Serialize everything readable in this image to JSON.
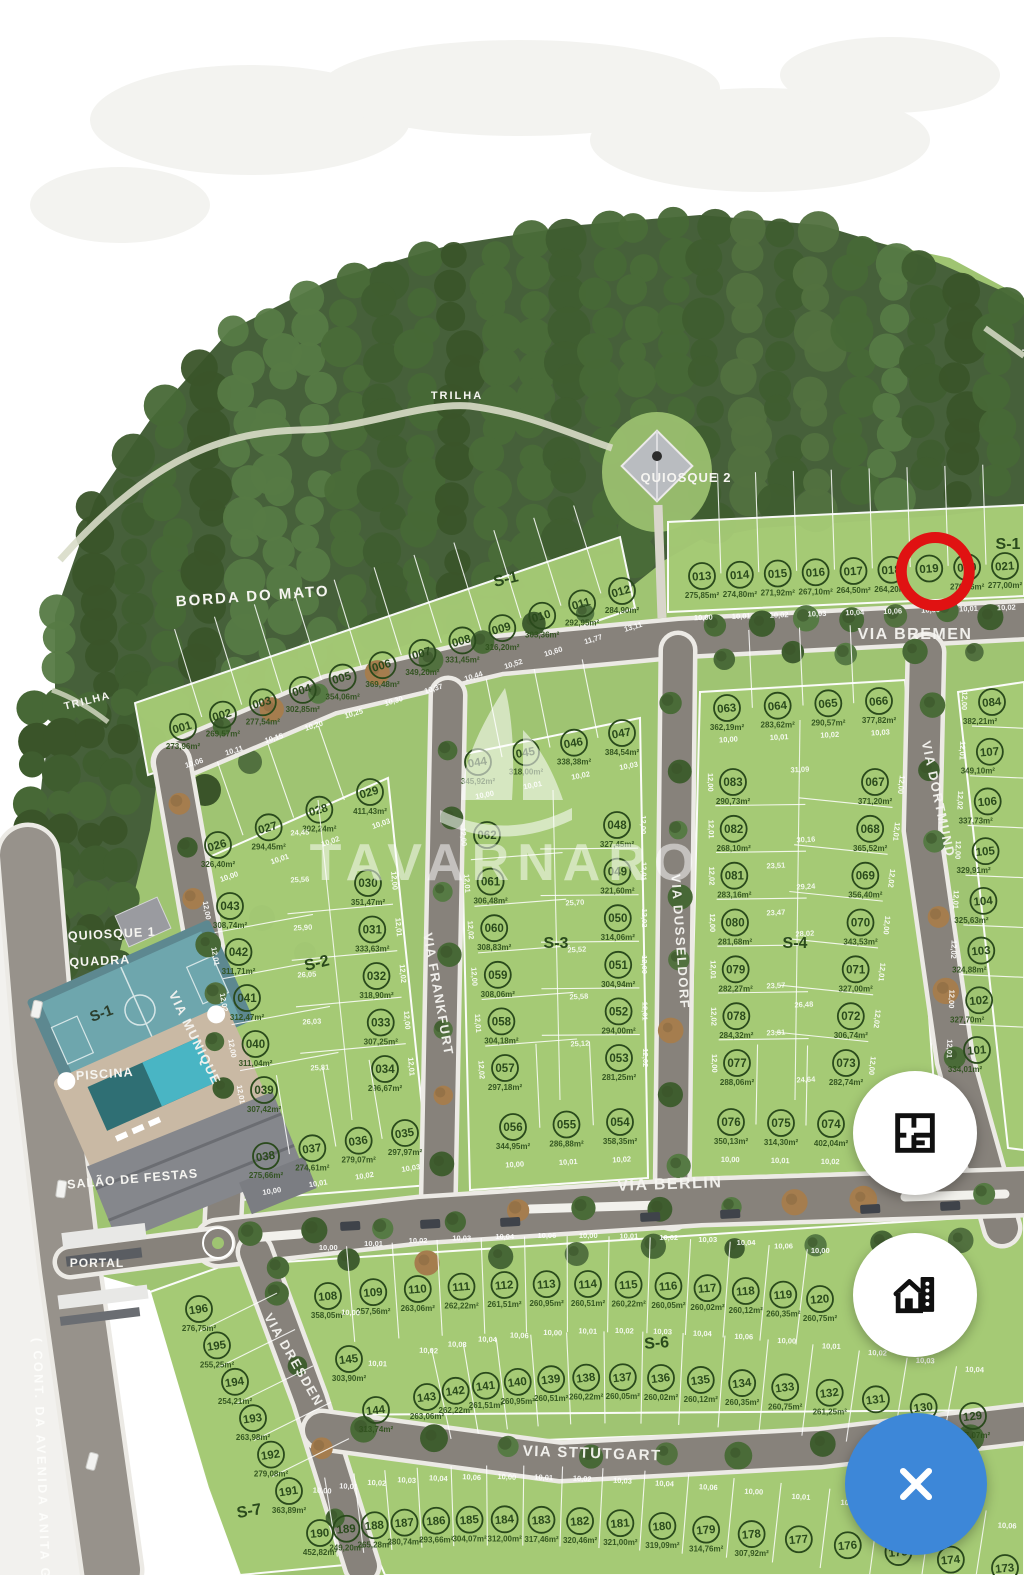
{
  "viewer": {
    "watermark": "TAVARNARO",
    "buttons": [
      {
        "id": "floorplan",
        "icon": "floor-plan-icon"
      },
      {
        "id": "units",
        "icon": "house-building-icon"
      },
      {
        "id": "close",
        "icon": "close-x-icon"
      }
    ]
  },
  "highlight": {
    "lot": "019",
    "color": "#e01212"
  },
  "labels": {
    "borda_do_mato": "BORDA DO MATO",
    "trilha_top": "TRILHA",
    "trilha_left": "TRILHA",
    "trilha_right": "TRILHA",
    "quiosque_1": "QUIOSQUE 1",
    "quiosque_2": "QUIOSQUE 2",
    "quadra": "QUADRA",
    "quadra_section": "S-1",
    "piscina": "PISCINA",
    "salao_de_festas": "SALÃO DE FESTAS",
    "portal": "PORTAL",
    "avenue": "( CONT. DA AVENIDA ANITA GARI"
  },
  "streets": [
    {
      "name": "VIA BREMEN"
    },
    {
      "name": "VIA MUNIQUE"
    },
    {
      "name": "VIA FRANKFURT"
    },
    {
      "name": "VIA DUSSELDORF"
    },
    {
      "name": "VIA DORTMUND"
    },
    {
      "name": "VIA BERLIN"
    },
    {
      "name": "VIA DRESDEN"
    },
    {
      "name": "VIA STTUTGART"
    }
  ],
  "sections": [
    {
      "id": "S-1",
      "strips": {
        "row_a": [
          {
            "n": "001",
            "a": "273,96m²"
          },
          {
            "n": "002",
            "a": "269,57m²"
          },
          {
            "n": "003",
            "a": "277,54m²"
          },
          {
            "n": "004",
            "a": "302,85m²"
          },
          {
            "n": "005",
            "a": "354,06m²"
          },
          {
            "n": "006",
            "a": "369,48m²"
          },
          {
            "n": "007",
            "a": "349,20m²"
          },
          {
            "n": "008",
            "a": "331,45m²"
          },
          {
            "n": "009",
            "a": "316,20m²"
          },
          {
            "n": "010",
            "a": "303,36m²"
          },
          {
            "n": "011",
            "a": "292,95m²"
          },
          {
            "n": "012",
            "a": "284,90m²"
          }
        ],
        "row_b": [
          {
            "n": "013",
            "a": "275,85m²"
          },
          {
            "n": "014",
            "a": "274,80m²"
          },
          {
            "n": "015",
            "a": "271,92m²"
          },
          {
            "n": "016",
            "a": "267,10m²"
          },
          {
            "n": "017",
            "a": "264,50m²"
          },
          {
            "n": "018",
            "a": "264,20m²"
          },
          {
            "n": "019",
            "a": "",
            "selected": true
          },
          {
            "n": "020",
            "a": "270,46m²"
          },
          {
            "n": "021",
            "a": "277,00m²"
          }
        ]
      }
    },
    {
      "id": "S-2",
      "strips": {
        "row_top": [
          {
            "n": "026",
            "a": "326,40m²"
          },
          {
            "n": "027",
            "a": "294,45m²"
          },
          {
            "n": "028",
            "a": "302,24m²"
          },
          {
            "n": "029",
            "a": "411,43m²"
          }
        ],
        "col_left": [
          {
            "n": "043",
            "a": "308,74m²"
          },
          {
            "n": "042",
            "a": "311,71m²"
          },
          {
            "n": "041",
            "a": "312,47m²"
          },
          {
            "n": "040",
            "a": "311,04m²"
          },
          {
            "n": "039",
            "a": "307,42m²"
          }
        ],
        "col_right": [
          {
            "n": "030",
            "a": "351,47m²"
          },
          {
            "n": "031",
            "a": "333,63m²"
          },
          {
            "n": "032",
            "a": "318,90m²"
          },
          {
            "n": "033",
            "a": "307,25m²"
          },
          {
            "n": "034",
            "a": "296,67m²"
          }
        ],
        "row_bottom": [
          {
            "n": "038",
            "a": "275,66m²"
          },
          {
            "n": "037",
            "a": "274,61m²"
          },
          {
            "n": "036",
            "a": "279,07m²"
          },
          {
            "n": "035",
            "a": "297,97m²"
          }
        ]
      }
    },
    {
      "id": "S-3",
      "strips": {
        "row_top": [
          {
            "n": "044",
            "a": "345,92m²"
          },
          {
            "n": "045",
            "a": "318,00m²"
          },
          {
            "n": "046",
            "a": "338,38m²"
          },
          {
            "n": "047",
            "a": "384,54m²"
          }
        ],
        "col_left": [
          {
            "n": "062",
            "a": ""
          },
          {
            "n": "061",
            "a": "306,48m²"
          },
          {
            "n": "060",
            "a": "308,83m²"
          },
          {
            "n": "059",
            "a": "308,06m²"
          },
          {
            "n": "058",
            "a": "304,18m²"
          },
          {
            "n": "057",
            "a": "297,18m²"
          }
        ],
        "col_right": [
          {
            "n": "048",
            "a": "327,45m²"
          },
          {
            "n": "049",
            "a": "321,60m²"
          },
          {
            "n": "050",
            "a": "314,06m²"
          },
          {
            "n": "051",
            "a": "304,94m²"
          },
          {
            "n": "052",
            "a": "294,00m²"
          },
          {
            "n": "053",
            "a": "281,25m²"
          }
        ],
        "row_bottom": [
          {
            "n": "056",
            "a": "344,95m²"
          },
          {
            "n": "055",
            "a": "286,88m²"
          },
          {
            "n": "054",
            "a": "358,35m²"
          }
        ]
      }
    },
    {
      "id": "S-4",
      "strips": {
        "row_top": [
          {
            "n": "063",
            "a": "362,19m²"
          },
          {
            "n": "064",
            "a": "283,62m²"
          },
          {
            "n": "065",
            "a": "290,57m²"
          },
          {
            "n": "066",
            "a": "377,82m²"
          }
        ],
        "col_left": [
          {
            "n": "083",
            "a": "290,73m²"
          },
          {
            "n": "082",
            "a": "268,10m²"
          },
          {
            "n": "081",
            "a": "283,16m²"
          },
          {
            "n": "080",
            "a": "281,68m²"
          },
          {
            "n": "079",
            "a": "282,27m²"
          },
          {
            "n": "078",
            "a": "284,32m²"
          },
          {
            "n": "077",
            "a": "288,06m²"
          }
        ],
        "col_right": [
          {
            "n": "067",
            "a": "371,20m²"
          },
          {
            "n": "068",
            "a": "365,52m²"
          },
          {
            "n": "069",
            "a": "356,40m²"
          },
          {
            "n": "070",
            "a": "343,53m²"
          },
          {
            "n": "071",
            "a": "327,00m²"
          },
          {
            "n": "072",
            "a": "306,74m²"
          },
          {
            "n": "073",
            "a": "282,74m²"
          }
        ],
        "row_bottom": [
          {
            "n": "076",
            "a": "350,13m²"
          },
          {
            "n": "075",
            "a": "314,30m²"
          },
          {
            "n": "074",
            "a": "402,04m²"
          }
        ]
      }
    },
    {
      "id": "",
      "strips": {
        "col_east": [
          {
            "n": "084",
            "a": "382,21m²"
          },
          {
            "n": "107",
            "a": "349,10m²"
          },
          {
            "n": "106",
            "a": "337,73m²"
          },
          {
            "n": "105",
            "a": "329,91m²"
          },
          {
            "n": "104",
            "a": "325,63m²"
          },
          {
            "n": "103",
            "a": "324,88m²"
          },
          {
            "n": "102",
            "a": "327,70m²"
          },
          {
            "n": "101",
            "a": "334,01m²"
          }
        ]
      }
    },
    {
      "id": "S-6",
      "strips": {
        "row_top": [
          {
            "n": "108",
            "a": "358,05m²"
          },
          {
            "n": "109",
            "a": "257,56m²"
          },
          {
            "n": "110",
            "a": "263,06m²"
          },
          {
            "n": "111",
            "a": "262,22m²"
          },
          {
            "n": "112",
            "a": "261,51m²"
          },
          {
            "n": "113",
            "a": "260,95m²"
          },
          {
            "n": "114",
            "a": "260,51m²"
          },
          {
            "n": "115",
            "a": "260,22m²"
          },
          {
            "n": "116",
            "a": "260,05m²"
          },
          {
            "n": "117",
            "a": "260,02m²"
          },
          {
            "n": "118",
            "a": "260,12m²"
          },
          {
            "n": "119",
            "a": "260,35m²"
          },
          {
            "n": "120",
            "a": "260,75m²"
          }
        ],
        "row_bottom": [
          {
            "n": "145",
            "a": "303,90m²"
          },
          {
            "n": "144",
            "a": "313,74m²"
          },
          {
            "n": "143",
            "a": "263,06m²"
          },
          {
            "n": "142",
            "a": "262,22m²"
          },
          {
            "n": "141",
            "a": "261,51m²"
          },
          {
            "n": "140",
            "a": "260,95m²"
          },
          {
            "n": "139",
            "a": "260,51m²"
          },
          {
            "n": "138",
            "a": "260,22m²"
          },
          {
            "n": "137",
            "a": "260,05m²"
          },
          {
            "n": "136",
            "a": "260,02m²"
          },
          {
            "n": "135",
            "a": "260,12m²"
          },
          {
            "n": "134",
            "a": "260,35m²"
          },
          {
            "n": "133",
            "a": "260,75m²"
          },
          {
            "n": "132",
            "a": "261,25m²"
          },
          {
            "n": "131",
            "a": ""
          },
          {
            "n": "130",
            "a": ""
          },
          {
            "n": "129",
            "a": "257,07m²"
          }
        ]
      }
    },
    {
      "id": "S-7",
      "strips": {
        "col": [
          {
            "n": "196",
            "a": "276,75m²"
          },
          {
            "n": "195",
            "a": "255,25m²"
          },
          {
            "n": "194",
            "a": "254,21m²"
          },
          {
            "n": "193",
            "a": "263,98m²"
          },
          {
            "n": "192",
            "a": "279,08m²"
          },
          {
            "n": "191",
            "a": "363,89m²"
          }
        ],
        "row_bottom": [
          {
            "n": "190",
            "a": "452,82m²"
          },
          {
            "n": "189",
            "a": "249,20m²"
          },
          {
            "n": "188",
            "a": "265,28m²"
          },
          {
            "n": "187",
            "a": "280,74m²"
          },
          {
            "n": "186",
            "a": "293,66m²"
          },
          {
            "n": "185",
            "a": "304,07m²"
          },
          {
            "n": "184",
            "a": "312,00m²"
          },
          {
            "n": "183",
            "a": "317,46m²"
          },
          {
            "n": "182",
            "a": "320,46m²"
          },
          {
            "n": "181",
            "a": "321,00m²"
          },
          {
            "n": "180",
            "a": "319,09m²"
          },
          {
            "n": "179",
            "a": "314,76m²"
          },
          {
            "n": "178",
            "a": "307,92m²"
          },
          {
            "n": "177",
            "a": ""
          },
          {
            "n": "176",
            "a": ""
          },
          {
            "n": "175",
            "a": ""
          },
          {
            "n": "174",
            "a": ""
          },
          {
            "n": "173",
            "a": ""
          }
        ]
      }
    }
  ],
  "dimension_labels": {
    "frontage": [
      "10,00",
      "10,01",
      "10,02",
      "10,03",
      "10,04",
      "10,06"
    ],
    "frontage_a": [
      "10,06",
      "10,11",
      "10,15",
      "10,20",
      "10,25",
      "10,30",
      "10,37",
      "10,44",
      "10,52",
      "10,60",
      "11,77",
      "13,11"
    ],
    "side": [
      "12,00",
      "12,01",
      "12,02"
    ],
    "interior": [
      "25,56",
      "25,90",
      "26,05",
      "26,03",
      "25,81",
      "25,70",
      "25,52",
      "25,58",
      "25,12",
      "23,51",
      "23,47",
      "23,57",
      "23,81",
      "30,16",
      "29,24",
      "28,02",
      "26,48",
      "31,09",
      "24,45",
      "24,64"
    ]
  },
  "colors": {
    "accent_blue": "#3d87d8",
    "highlight_red": "#e01212",
    "terrain_green": "#9fc472",
    "block_green": "#a6cb76",
    "forest_green": "#46603a",
    "road_gray": "#87827b",
    "avenue_gray": "#97928b",
    "court_teal": "#6ea6ad",
    "pool_teal": "#49b5c4",
    "sand_beige": "#c9b9a4",
    "label_green": "#2a4a1c"
  }
}
